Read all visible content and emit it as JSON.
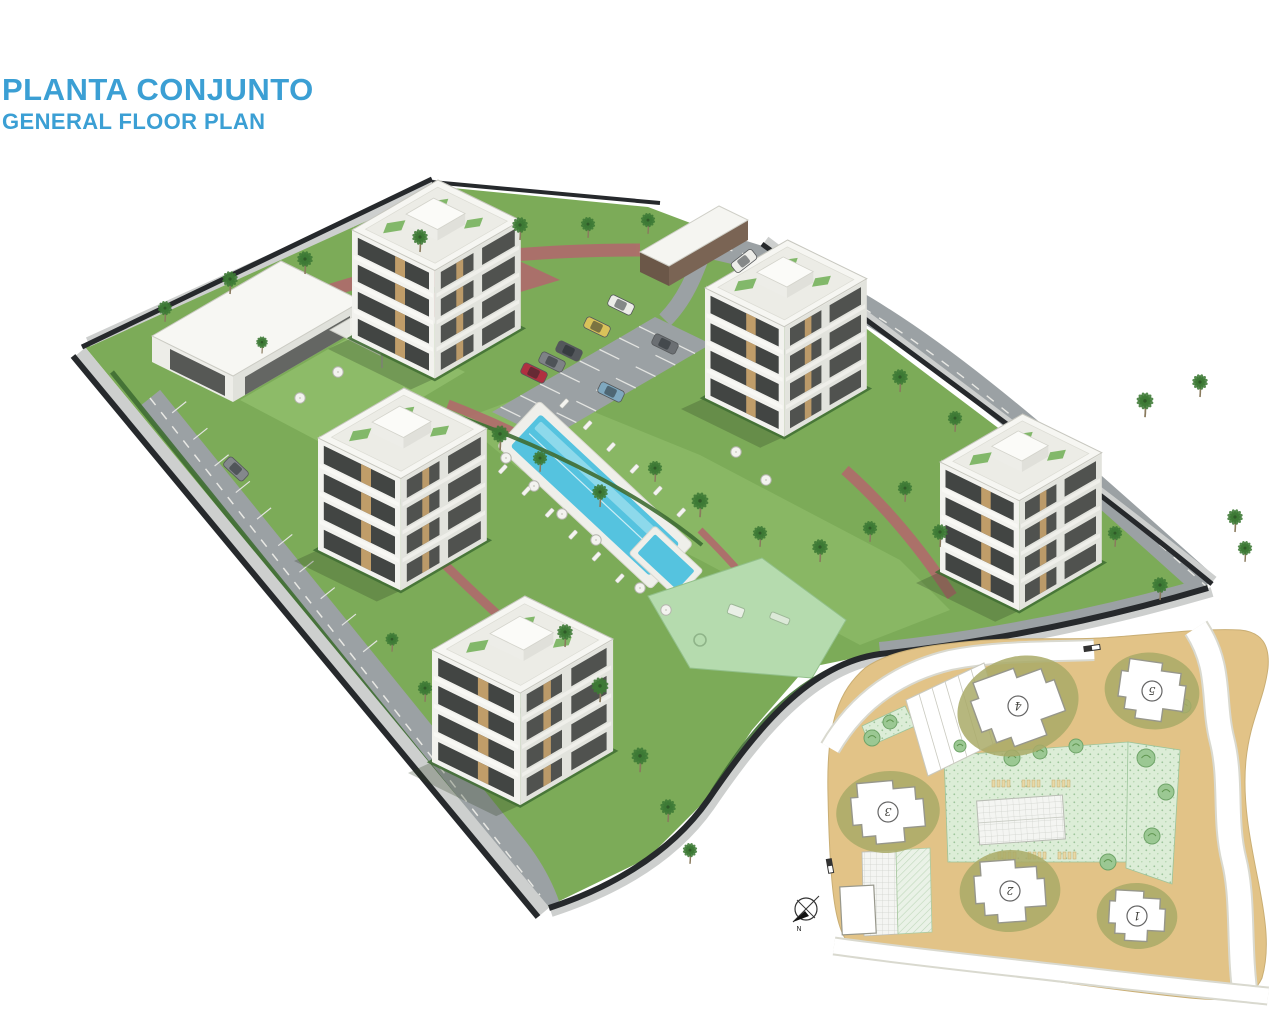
{
  "header": {
    "title": "PLANTA CONJUNTO",
    "subtitle": "GENERAL FLOOR PLAN"
  },
  "site_plan": {
    "buildings": [
      {
        "label": "1"
      },
      {
        "label": "2"
      },
      {
        "label": "3"
      },
      {
        "label": "4"
      },
      {
        "label": "5"
      }
    ],
    "compass_label": "N"
  },
  "colors": {
    "page_bg": "#FFFFFF",
    "title_blue": "#3B9FD4",
    "grass": "#7CAB58",
    "grass_light": "#8FBC6A",
    "hedge": "#3F6D33",
    "palm": "#3E7A35",
    "road": "#9BA1A4",
    "sidewalk": "#CDCFCE",
    "wall_dark": "#26292C",
    "brick_path": "#B06A6C",
    "building_white": "#F2F2EE",
    "building_shade": "#E2E3DD",
    "window_dark": "#2F3230",
    "wood_accent": "#C7A26B",
    "roof_terrace": "#ECECE6",
    "roof_green": "#77B25C",
    "pool_water": "#55C3DF",
    "pool_water_light": "#A5E2EF",
    "playground": "#B5DBAE",
    "car_red": "#B03040",
    "car_yellow": "#D9C25A",
    "car_blue": "#7FA8BF",
    "plan_tan": "#E2C387",
    "plan_olive": "#8A8C4D",
    "plan_green_hatch": "#DCEDD7",
    "plan_tree": "#9BC893"
  }
}
